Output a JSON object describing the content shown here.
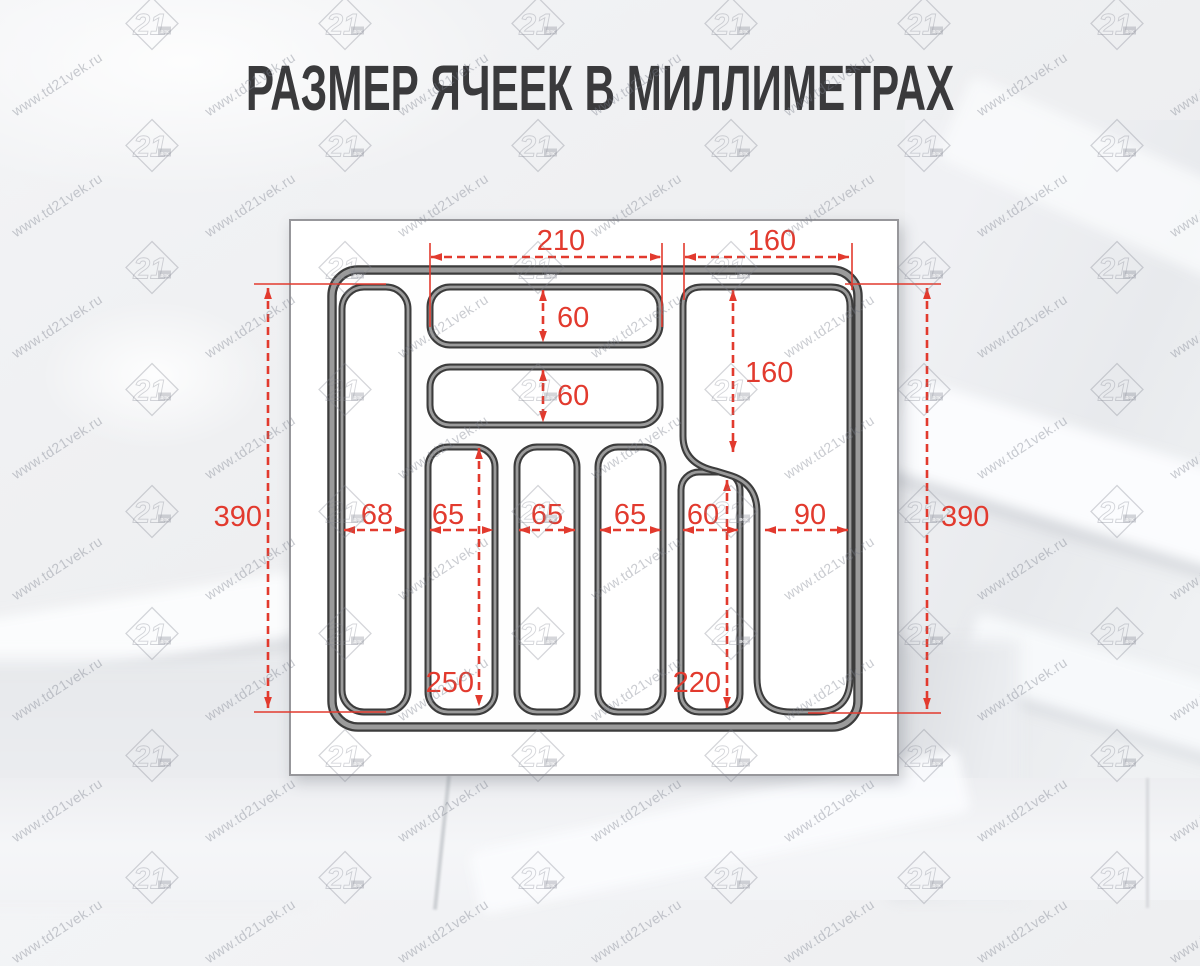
{
  "title": "РАЗМЕР ЯЧЕЕК В МИЛЛИМЕТРАХ",
  "watermark": {
    "url": "www.td21vek.ru",
    "logo_number": "21",
    "logo_caption": "век"
  },
  "dims": {
    "top_middle_width": "210",
    "top_right_width": "160",
    "cell1_height": "60",
    "cell2_height": "60",
    "right_cell_height": "160",
    "left_total_height": "390",
    "right_total_height": "390",
    "col1_width": "68",
    "col2_width": "65",
    "col3_width": "65",
    "col4_width": "65",
    "col5_width": "60",
    "col6_width": "90",
    "mid_cols_height": "250",
    "col5_height": "220"
  },
  "colors": {
    "dimension_red": "#e23a2e",
    "wall_dark": "#3c3c3c",
    "wall_light": "#9b9b9b",
    "title_text": "#3a3a3c",
    "box_border": "#97979b"
  }
}
